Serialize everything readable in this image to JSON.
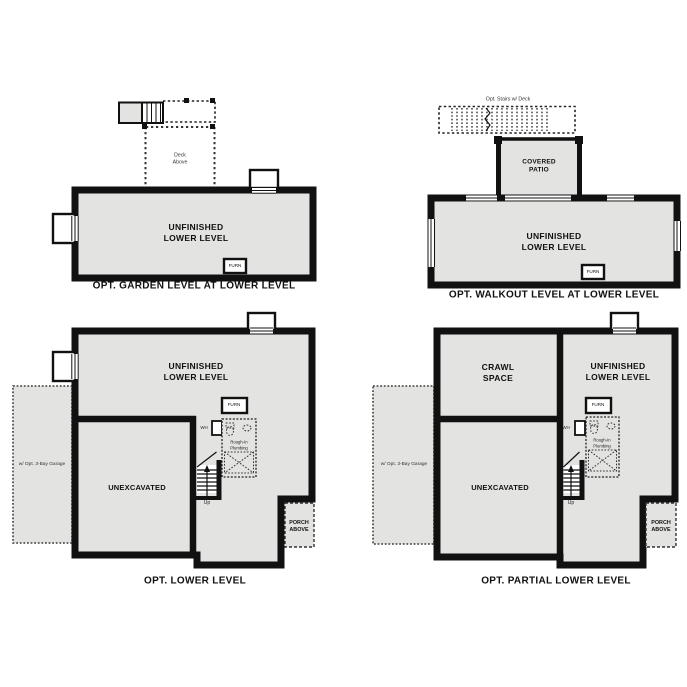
{
  "colors": {
    "background": "#ffffff",
    "floor_fill": "#e3e3e1",
    "wall": "#111111",
    "text": "#111111"
  },
  "plans": {
    "garden": {
      "caption": "OPT. GARDEN LEVEL AT LOWER LEVEL",
      "unfinished": "UNFINISHED\nLOWER LEVEL",
      "deck": "Deck\nAbove",
      "furn": "FURN"
    },
    "walkout": {
      "caption": "OPT. WALKOUT LEVEL AT LOWER LEVEL",
      "unfinished": "UNFINISHED\nLOWER LEVEL",
      "patio": "COVERED\nPATIO",
      "opt_stairs": "Opt. Stairs w/ Deck",
      "furn": "FURN"
    },
    "lower": {
      "caption": "OPT. LOWER LEVEL",
      "unfinished": "UNFINISHED\nLOWER LEVEL",
      "unexcavated": "UNEXCAVATED",
      "garage": "w/ Opt. 3-Bay Garage",
      "porch": "PORCH\nABOVE",
      "furn": "FURN",
      "wh": "WH",
      "up": "Up",
      "plumbing": "Rough-In\nPlumbing"
    },
    "partial": {
      "caption": "OPT. PARTIAL LOWER LEVEL",
      "crawl": "CRAWL\nSPACE",
      "unfinished": "UNFINISHED\nLOWER LEVEL",
      "unexcavated": "UNEXCAVATED",
      "garage": "w/ Opt. 3-Bay Garage",
      "porch": "PORCH\nABOVE",
      "furn": "FURN",
      "wh": "WH",
      "up": "Up",
      "plumbing": "Rough-In\nPlumbing"
    }
  }
}
